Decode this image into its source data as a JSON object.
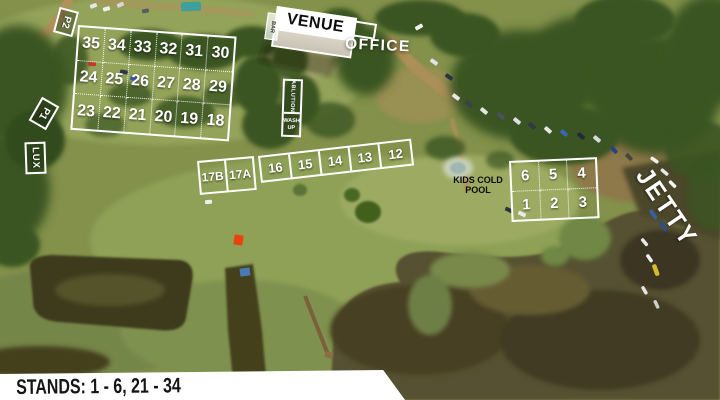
{
  "labels": {
    "venue": "VENUE",
    "office": "OFFICE",
    "bar": "BAR",
    "ablution": "ABLUTION",
    "wash_line1": "WASH",
    "wash_line2": "UP",
    "kids_pool_line1": "KIDS COLD",
    "kids_pool_line2": "POOL",
    "jetty": "JETTY",
    "p1": "P1",
    "p2": "P2",
    "lux": "LUX"
  },
  "stands": {
    "north_grid": {
      "rows": [
        [
          "35",
          "34",
          "33",
          "32",
          "31",
          "30"
        ],
        [
          "24",
          "25",
          "26",
          "27",
          "28",
          "29"
        ],
        [
          "23",
          "22",
          "21",
          "20",
          "19",
          "18"
        ]
      ]
    },
    "pair_17": [
      "17B",
      "17A"
    ],
    "mid_row": [
      "16",
      "15",
      "14",
      "13",
      "12"
    ],
    "east_grid": {
      "rows": [
        [
          "6",
          "5",
          "4"
        ],
        [
          "1",
          "2",
          "3"
        ]
      ]
    }
  },
  "footer": {
    "stands_text": "STANDS: 1 - 6, 21 - 34"
  },
  "colors": {
    "overlay_white": "#ffffff",
    "label_black": "#0d0d0d",
    "grass": "#83914b",
    "trees": "#3a5522",
    "water": "#575130",
    "dirt_road": "#b2905a",
    "tent_red": "#e8430f",
    "pool_teal": "#3e9f9b"
  }
}
